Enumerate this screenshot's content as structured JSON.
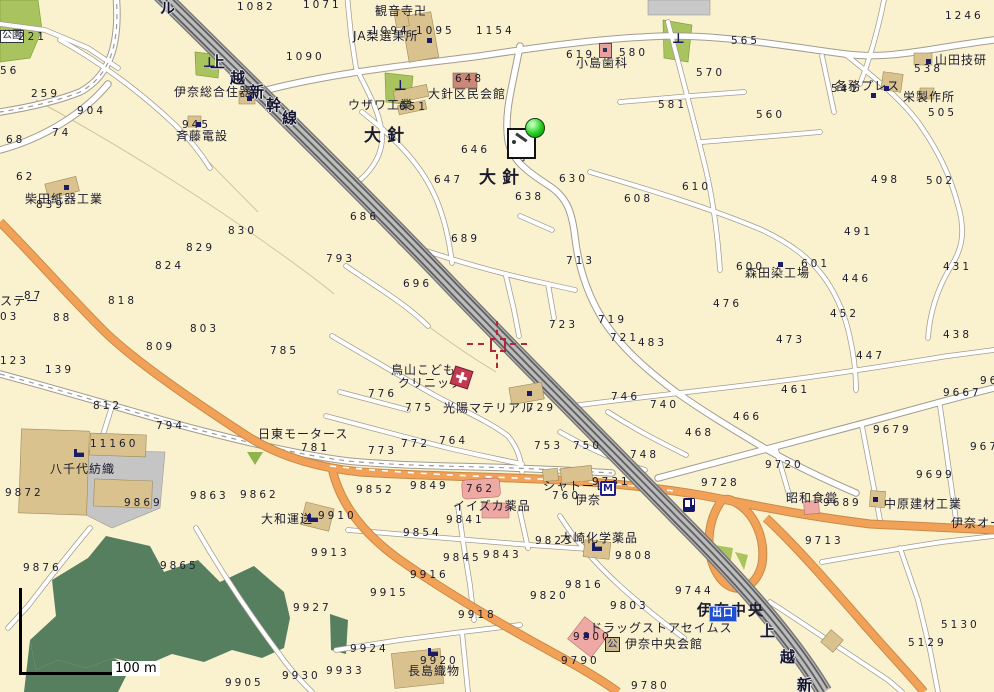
{
  "map": {
    "colors": {
      "background": "#FAF2CE",
      "park_green": "#A9C45E",
      "forest_green": "#567F60",
      "orange_road": "#F2A159",
      "railway_gray": "#B9B9B9",
      "building_tan": "#D9C28D",
      "building_pink": "#EFA9A4",
      "icon_navy": "#1C1C66",
      "marker_green": "#24CC20",
      "crosshair_red": "#B02838",
      "exit_badge_blue": "#1E50D0"
    },
    "scale_bar": {
      "label": "100 m"
    },
    "badges": {
      "exit": "出口",
      "m": "M",
      "hall": "公"
    },
    "icon_glyphs": {
      "torii": "⊥"
    },
    "labels": [
      {
        "t": "ル",
        "x": 160,
        "y": 1,
        "c": "rail"
      },
      {
        "t": "上",
        "x": 210,
        "y": 55,
        "c": "rail"
      },
      {
        "t": "越",
        "x": 230,
        "y": 71,
        "c": "rail"
      },
      {
        "t": "新",
        "x": 249,
        "y": 85,
        "c": "rail"
      },
      {
        "t": "幹",
        "x": 266,
        "y": 98,
        "c": "rail"
      },
      {
        "t": "線",
        "x": 282,
        "y": 111,
        "c": "rail"
      },
      {
        "t": "上",
        "x": 760,
        "y": 624,
        "c": "rail"
      },
      {
        "t": "越",
        "x": 780,
        "y": 650,
        "c": "rail"
      },
      {
        "t": "新",
        "x": 797,
        "y": 678,
        "c": "rail"
      },
      {
        "t": "公園",
        "x": 0,
        "y": 30,
        "c": "pk"
      },
      {
        "t": "1082",
        "x": 237,
        "y": 2,
        "c": "n"
      },
      {
        "t": "1071",
        "x": 303,
        "y": 0,
        "c": "n"
      },
      {
        "t": "1154",
        "x": 476,
        "y": 26,
        "c": "n"
      },
      {
        "t": "1094",
        "x": 371,
        "y": 26,
        "c": "n"
      },
      {
        "t": "1095",
        "x": 416,
        "y": 26,
        "c": "n"
      },
      {
        "t": "1090",
        "x": 286,
        "y": 52,
        "c": "n"
      },
      {
        "t": "1246",
        "x": 945,
        "y": 11,
        "c": "n"
      },
      {
        "t": "221",
        "x": 18,
        "y": 32,
        "c": "n"
      },
      {
        "t": "56",
        "x": 0,
        "y": 66,
        "c": "n"
      },
      {
        "t": "259",
        "x": 31,
        "y": 89,
        "c": "n"
      },
      {
        "t": "904",
        "x": 77,
        "y": 106,
        "c": "n"
      },
      {
        "t": "74",
        "x": 52,
        "y": 128,
        "c": "n"
      },
      {
        "t": "68",
        "x": 6,
        "y": 135,
        "c": "n"
      },
      {
        "t": "62",
        "x": 16,
        "y": 172,
        "c": "n"
      },
      {
        "t": "観音寺卍",
        "x": 375,
        "y": 5,
        "c": "p"
      },
      {
        "t": "JA梨選果所",
        "x": 353,
        "y": 30,
        "c": "p"
      },
      {
        "t": "小島歯科",
        "x": 576,
        "y": 57,
        "c": "p"
      },
      {
        "t": "619",
        "x": 566,
        "y": 50,
        "c": "n"
      },
      {
        "t": "580",
        "x": 619,
        "y": 48,
        "c": "n"
      },
      {
        "t": "565",
        "x": 731,
        "y": 36,
        "c": "n"
      },
      {
        "t": "570",
        "x": 696,
        "y": 68,
        "c": "n"
      },
      {
        "t": "581",
        "x": 658,
        "y": 100,
        "c": "n"
      },
      {
        "t": "560",
        "x": 756,
        "y": 110,
        "c": "n"
      },
      {
        "t": "538",
        "x": 914,
        "y": 64,
        "c": "n"
      },
      {
        "t": "541",
        "x": 831,
        "y": 84,
        "c": "n"
      },
      {
        "t": "505",
        "x": 928,
        "y": 108,
        "c": "n"
      },
      {
        "t": "502",
        "x": 926,
        "y": 176,
        "c": "n"
      },
      {
        "t": "498",
        "x": 871,
        "y": 175,
        "c": "n"
      },
      {
        "t": "山田技研",
        "x": 935,
        "y": 54,
        "c": "p"
      },
      {
        "t": "各務プレス",
        "x": 835,
        "y": 80,
        "c": "p"
      },
      {
        "t": "栄製作所",
        "x": 903,
        "y": 91,
        "c": "p"
      },
      {
        "t": "大針区民会館",
        "x": 428,
        "y": 88,
        "c": "p"
      },
      {
        "t": "648",
        "x": 455,
        "y": 74,
        "c": "n"
      },
      {
        "t": "ウザワ工業",
        "x": 348,
        "y": 99,
        "c": "p"
      },
      {
        "t": "651",
        "x": 399,
        "y": 102,
        "c": "n"
      },
      {
        "t": "伊奈総合住器",
        "x": 174,
        "y": 86,
        "c": "p"
      },
      {
        "t": "斉藤電設",
        "x": 176,
        "y": 130,
        "c": "p"
      },
      {
        "t": "945",
        "x": 182,
        "y": 120,
        "c": "n"
      },
      {
        "t": "大針",
        "x": 364,
        "y": 128,
        "c": "big"
      },
      {
        "t": "大針",
        "x": 479,
        "y": 170,
        "c": "big"
      },
      {
        "t": "寧",
        "x": 518,
        "y": 150,
        "c": "p"
      },
      {
        "t": "646",
        "x": 461,
        "y": 145,
        "c": "n"
      },
      {
        "t": "647",
        "x": 434,
        "y": 175,
        "c": "n"
      },
      {
        "t": "638",
        "x": 515,
        "y": 192,
        "c": "n"
      },
      {
        "t": "630",
        "x": 559,
        "y": 174,
        "c": "n"
      },
      {
        "t": "608",
        "x": 624,
        "y": 194,
        "c": "n"
      },
      {
        "t": "610",
        "x": 682,
        "y": 182,
        "c": "n"
      },
      {
        "t": "柴田紙器工業",
        "x": 25,
        "y": 193,
        "c": "p"
      },
      {
        "t": "839",
        "x": 36,
        "y": 200,
        "c": "n"
      },
      {
        "t": "830",
        "x": 228,
        "y": 226,
        "c": "n"
      },
      {
        "t": "829",
        "x": 186,
        "y": 243,
        "c": "n"
      },
      {
        "t": "824",
        "x": 155,
        "y": 261,
        "c": "n"
      },
      {
        "t": "818",
        "x": 108,
        "y": 296,
        "c": "n"
      },
      {
        "t": "87",
        "x": 24,
        "y": 291,
        "c": "n"
      },
      {
        "t": "88",
        "x": 53,
        "y": 313,
        "c": "n"
      },
      {
        "t": "ステー",
        "x": 0,
        "y": 295,
        "c": "p"
      },
      {
        "t": "03",
        "x": 0,
        "y": 312,
        "c": "n"
      },
      {
        "t": "123",
        "x": 0,
        "y": 356,
        "c": "n"
      },
      {
        "t": "139",
        "x": 45,
        "y": 365,
        "c": "n"
      },
      {
        "t": "803",
        "x": 190,
        "y": 324,
        "c": "n"
      },
      {
        "t": "809",
        "x": 146,
        "y": 342,
        "c": "n"
      },
      {
        "t": "785",
        "x": 270,
        "y": 346,
        "c": "n"
      },
      {
        "t": "793",
        "x": 326,
        "y": 254,
        "c": "n"
      },
      {
        "t": "686",
        "x": 350,
        "y": 212,
        "c": "n"
      },
      {
        "t": "696",
        "x": 403,
        "y": 279,
        "c": "n"
      },
      {
        "t": "689",
        "x": 451,
        "y": 234,
        "c": "n"
      },
      {
        "t": "713",
        "x": 566,
        "y": 256,
        "c": "n"
      },
      {
        "t": "719",
        "x": 598,
        "y": 315,
        "c": "n"
      },
      {
        "t": "723",
        "x": 549,
        "y": 320,
        "c": "n"
      },
      {
        "t": "721",
        "x": 610,
        "y": 333,
        "c": "n"
      },
      {
        "t": "森田染工場",
        "x": 745,
        "y": 267,
        "c": "p"
      },
      {
        "t": "600",
        "x": 736,
        "y": 262,
        "c": "n"
      },
      {
        "t": "601",
        "x": 801,
        "y": 259,
        "c": "n"
      },
      {
        "t": "491",
        "x": 844,
        "y": 227,
        "c": "n"
      },
      {
        "t": "446",
        "x": 842,
        "y": 274,
        "c": "n"
      },
      {
        "t": "476",
        "x": 713,
        "y": 299,
        "c": "n"
      },
      {
        "t": "452",
        "x": 830,
        "y": 309,
        "c": "n"
      },
      {
        "t": "431",
        "x": 943,
        "y": 262,
        "c": "n"
      },
      {
        "t": "438",
        "x": 943,
        "y": 330,
        "c": "n"
      },
      {
        "t": "447",
        "x": 856,
        "y": 351,
        "c": "n"
      },
      {
        "t": "473",
        "x": 776,
        "y": 335,
        "c": "n"
      },
      {
        "t": "461",
        "x": 781,
        "y": 385,
        "c": "n"
      },
      {
        "t": "466",
        "x": 733,
        "y": 412,
        "c": "n"
      },
      {
        "t": "468",
        "x": 685,
        "y": 428,
        "c": "n"
      },
      {
        "t": "740",
        "x": 650,
        "y": 400,
        "c": "n"
      },
      {
        "t": "746",
        "x": 611,
        "y": 392,
        "c": "n"
      },
      {
        "t": "748",
        "x": 630,
        "y": 450,
        "c": "n"
      },
      {
        "t": "483",
        "x": 638,
        "y": 338,
        "c": "n"
      },
      {
        "t": "鳥山こども",
        "x": 391,
        "y": 364,
        "c": "p"
      },
      {
        "t": "クリニック",
        "x": 398,
        "y": 377,
        "c": "p"
      },
      {
        "t": "776",
        "x": 368,
        "y": 389,
        "c": "n"
      },
      {
        "t": "775",
        "x": 405,
        "y": 403,
        "c": "n"
      },
      {
        "t": "光陽マテリアル",
        "x": 443,
        "y": 402,
        "c": "p"
      },
      {
        "t": "729",
        "x": 527,
        "y": 403,
        "c": "n"
      },
      {
        "t": "773",
        "x": 368,
        "y": 446,
        "c": "n"
      },
      {
        "t": "772",
        "x": 401,
        "y": 439,
        "c": "n"
      },
      {
        "t": "764",
        "x": 439,
        "y": 436,
        "c": "n"
      },
      {
        "t": "753",
        "x": 534,
        "y": 441,
        "c": "n"
      },
      {
        "t": "750",
        "x": 573,
        "y": 441,
        "c": "n"
      },
      {
        "t": "日東モータース",
        "x": 258,
        "y": 428,
        "c": "p"
      },
      {
        "t": "781",
        "x": 301,
        "y": 443,
        "c": "n"
      },
      {
        "t": "812",
        "x": 93,
        "y": 401,
        "c": "n"
      },
      {
        "t": "794",
        "x": 156,
        "y": 421,
        "c": "n"
      },
      {
        "t": "11160",
        "x": 90,
        "y": 439,
        "c": "n"
      },
      {
        "t": "八千代紡織",
        "x": 50,
        "y": 463,
        "c": "p"
      },
      {
        "t": "9872",
        "x": 5,
        "y": 488,
        "c": "n"
      },
      {
        "t": "9869",
        "x": 124,
        "y": 498,
        "c": "n"
      },
      {
        "t": "9863",
        "x": 190,
        "y": 491,
        "c": "n"
      },
      {
        "t": "9862",
        "x": 240,
        "y": 490,
        "c": "n"
      },
      {
        "t": "9876",
        "x": 23,
        "y": 563,
        "c": "n"
      },
      {
        "t": "9865",
        "x": 160,
        "y": 561,
        "c": "n"
      },
      {
        "t": "大和運送",
        "x": 261,
        "y": 513,
        "c": "p"
      },
      {
        "t": "9910",
        "x": 318,
        "y": 511,
        "c": "n"
      },
      {
        "t": "9913",
        "x": 311,
        "y": 548,
        "c": "n"
      },
      {
        "t": "9927",
        "x": 293,
        "y": 603,
        "c": "n"
      },
      {
        "t": "9905",
        "x": 225,
        "y": 678,
        "c": "n"
      },
      {
        "t": "9930",
        "x": 282,
        "y": 671,
        "c": "n"
      },
      {
        "t": "9933",
        "x": 326,
        "y": 666,
        "c": "n"
      },
      {
        "t": "9924",
        "x": 350,
        "y": 644,
        "c": "n"
      },
      {
        "t": "9915",
        "x": 370,
        "y": 588,
        "c": "n"
      },
      {
        "t": "9916",
        "x": 410,
        "y": 570,
        "c": "n"
      },
      {
        "t": "9918",
        "x": 458,
        "y": 610,
        "c": "n"
      },
      {
        "t": "9920",
        "x": 420,
        "y": 656,
        "c": "n"
      },
      {
        "t": "長島織物",
        "x": 408,
        "y": 665,
        "c": "p"
      },
      {
        "t": "9854",
        "x": 403,
        "y": 528,
        "c": "n"
      },
      {
        "t": "9841",
        "x": 446,
        "y": 515,
        "c": "n"
      },
      {
        "t": "イイズカ薬品",
        "x": 453,
        "y": 500,
        "c": "p"
      },
      {
        "t": "9845",
        "x": 443,
        "y": 553,
        "c": "n"
      },
      {
        "t": "9843",
        "x": 483,
        "y": 550,
        "c": "n"
      },
      {
        "t": "9823",
        "x": 535,
        "y": 536,
        "c": "n"
      },
      {
        "t": "大崎化学薬品",
        "x": 560,
        "y": 532,
        "c": "p"
      },
      {
        "t": "9808",
        "x": 615,
        "y": 551,
        "c": "n"
      },
      {
        "t": "9816",
        "x": 565,
        "y": 580,
        "c": "n"
      },
      {
        "t": "9820",
        "x": 530,
        "y": 591,
        "c": "n"
      },
      {
        "t": "9803",
        "x": 610,
        "y": 601,
        "c": "n"
      },
      {
        "t": "ドラッグストアセイムス",
        "x": 590,
        "y": 622,
        "c": "p"
      },
      {
        "t": "9800",
        "x": 573,
        "y": 632,
        "c": "n"
      },
      {
        "t": "伊奈中央会館",
        "x": 625,
        "y": 638,
        "c": "p"
      },
      {
        "t": "9790",
        "x": 561,
        "y": 656,
        "c": "n"
      },
      {
        "t": "9780",
        "x": 631,
        "y": 681,
        "c": "n"
      },
      {
        "t": "9744",
        "x": 675,
        "y": 586,
        "c": "n"
      },
      {
        "t": "9713",
        "x": 805,
        "y": 536,
        "c": "n"
      },
      {
        "t": "5130",
        "x": 941,
        "y": 620,
        "c": "n"
      },
      {
        "t": "5129",
        "x": 908,
        "y": 638,
        "c": "n"
      },
      {
        "t": "9852",
        "x": 356,
        "y": 485,
        "c": "n"
      },
      {
        "t": "9849",
        "x": 410,
        "y": 481,
        "c": "n"
      },
      {
        "t": "762",
        "x": 466,
        "y": 484,
        "c": "n"
      },
      {
        "t": "シャトーレ",
        "x": 543,
        "y": 480,
        "c": "p"
      },
      {
        "t": "760",
        "x": 552,
        "y": 491,
        "c": "n"
      },
      {
        "t": "伊奈",
        "x": 575,
        "y": 494,
        "c": "p"
      },
      {
        "t": "9731",
        "x": 592,
        "y": 477,
        "c": "n"
      },
      {
        "t": "昭和食堂",
        "x": 786,
        "y": 492,
        "c": "p"
      },
      {
        "t": "9689",
        "x": 823,
        "y": 498,
        "c": "n"
      },
      {
        "t": "中原建材工業",
        "x": 884,
        "y": 498,
        "c": "p"
      },
      {
        "t": "伊奈オー",
        "x": 951,
        "y": 517,
        "c": "p"
      },
      {
        "t": "9679",
        "x": 873,
        "y": 425,
        "c": "n"
      },
      {
        "t": "9667",
        "x": 943,
        "y": 388,
        "c": "n"
      },
      {
        "t": "96",
        "x": 980,
        "y": 376,
        "c": "n"
      },
      {
        "t": "967",
        "x": 970,
        "y": 442,
        "c": "n"
      },
      {
        "t": "9720",
        "x": 765,
        "y": 460,
        "c": "n"
      },
      {
        "t": "9728",
        "x": 701,
        "y": 478,
        "c": "n"
      },
      {
        "t": "9699",
        "x": 916,
        "y": 470,
        "c": "n"
      },
      {
        "t": "伊奈中央",
        "x": 697,
        "y": 603,
        "c": "sta"
      }
    ],
    "icons": [
      {
        "k": "torii",
        "x": 203,
        "y": 57
      },
      {
        "k": "torii",
        "x": 394,
        "y": 80
      },
      {
        "k": "torii",
        "x": 672,
        "y": 33
      },
      {
        "k": "factory",
        "x": 74,
        "y": 449
      },
      {
        "k": "factory",
        "x": 428,
        "y": 648
      },
      {
        "k": "factory",
        "x": 592,
        "y": 543
      },
      {
        "k": "factory",
        "x": 308,
        "y": 514
      },
      {
        "k": "building-dot",
        "x": 427,
        "y": 38
      },
      {
        "k": "building-dot",
        "x": 196,
        "y": 122
      },
      {
        "k": "building-dot",
        "x": 247,
        "y": 96
      },
      {
        "k": "building-dot",
        "x": 64,
        "y": 185
      },
      {
        "k": "building-dot",
        "x": 926,
        "y": 59
      },
      {
        "k": "building-dot",
        "x": 884,
        "y": 86
      },
      {
        "k": "building-dot",
        "x": 871,
        "y": 93
      },
      {
        "k": "building-dot",
        "x": 778,
        "y": 262
      },
      {
        "k": "building-dot",
        "x": 527,
        "y": 391
      },
      {
        "k": "building-dot",
        "x": 873,
        "y": 497
      },
      {
        "k": "building-dot",
        "x": 584,
        "y": 633
      },
      {
        "k": "gas-station",
        "x": 683,
        "y": 498
      },
      {
        "k": "clinic-cross",
        "x": 452,
        "y": 368
      },
      {
        "k": "dentist",
        "x": 599,
        "y": 43
      }
    ]
  }
}
